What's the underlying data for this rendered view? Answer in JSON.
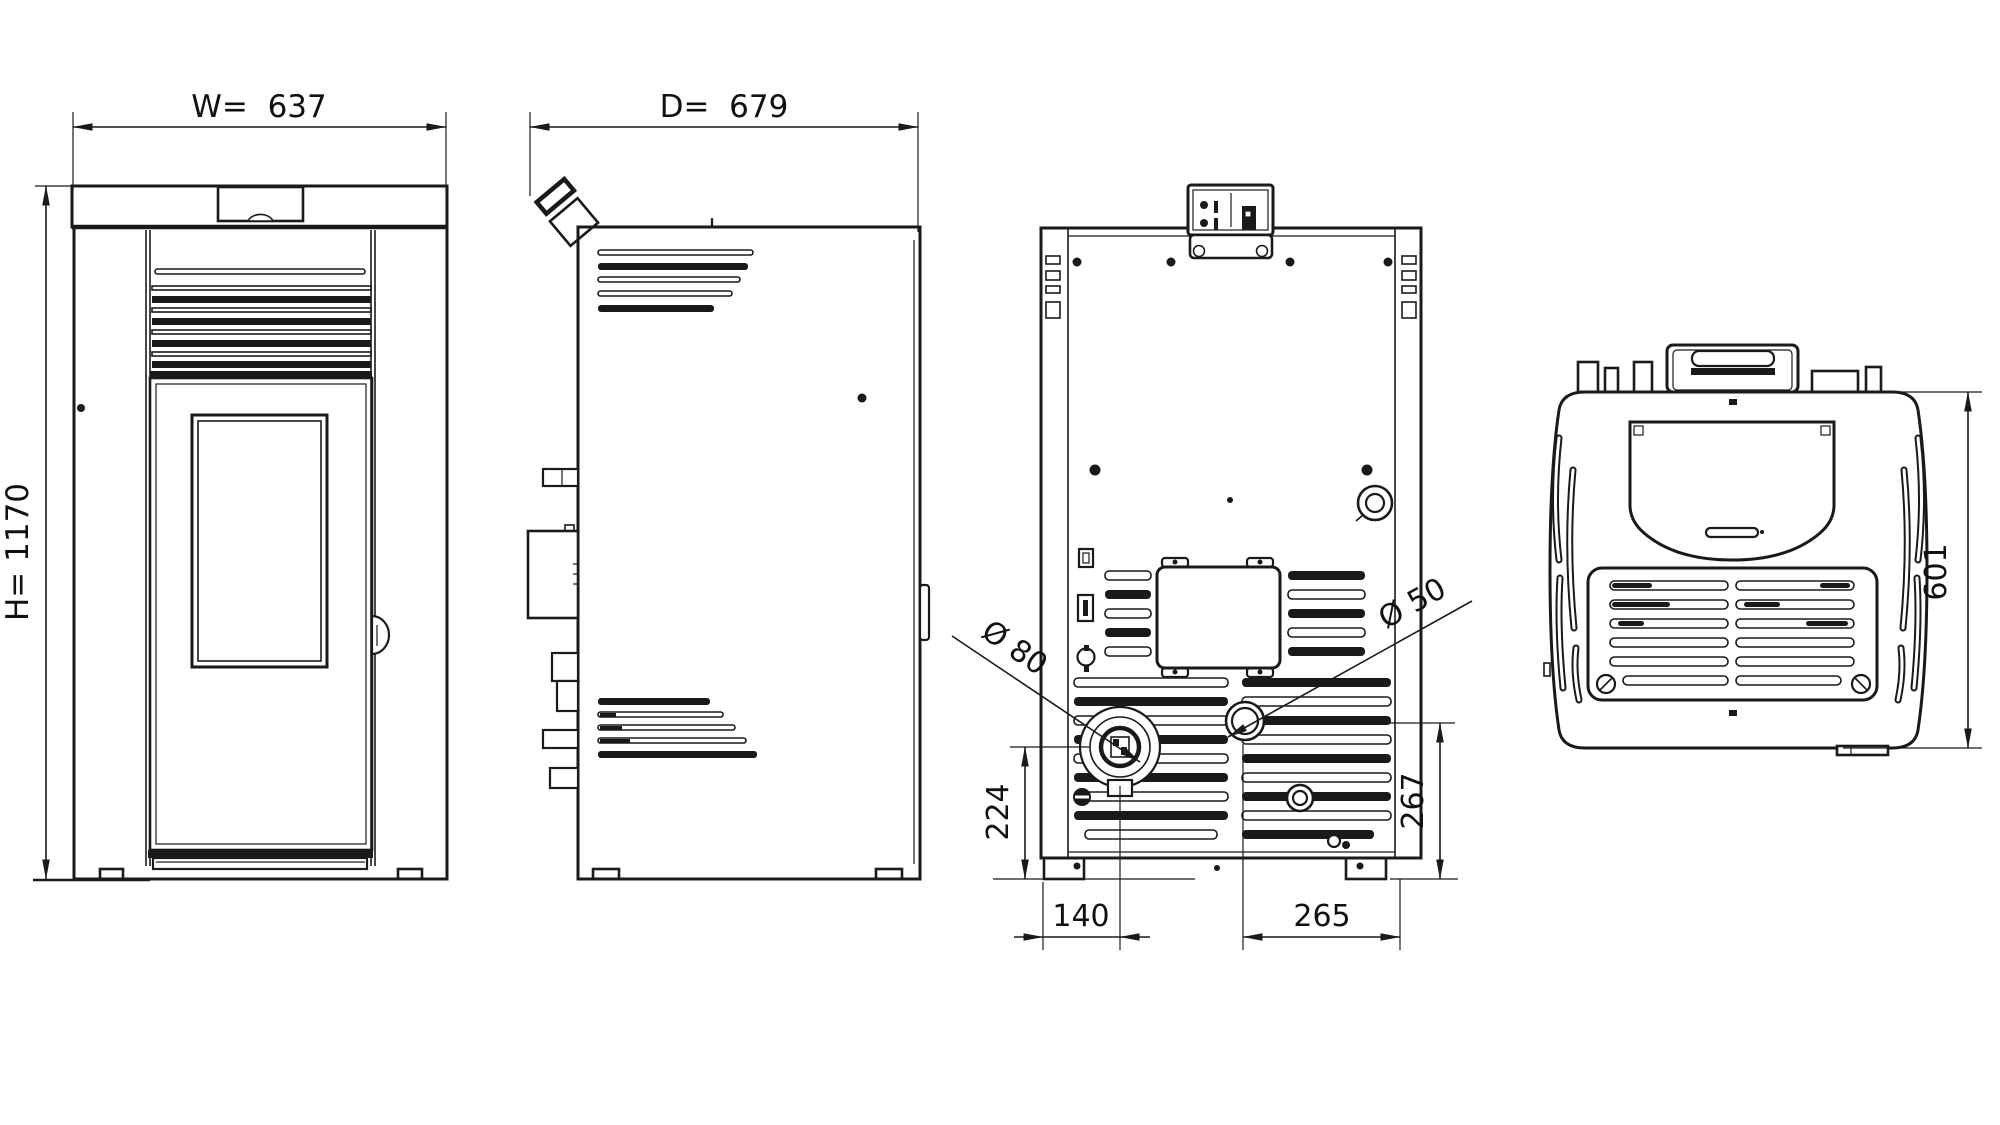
{
  "drawing": {
    "type": "technical-dimensional-drawing",
    "subject": "pellet stove — four orthographic views",
    "background_color": "#ffffff",
    "line_color": "#1a1a1a",
    "views": {
      "front": {
        "name": "front view"
      },
      "side": {
        "name": "side view"
      },
      "rear": {
        "name": "rear view"
      },
      "top": {
        "name": "top view"
      }
    },
    "dimensions": {
      "width": "W=  637",
      "depth": "D=  679",
      "height": "H= 1170",
      "flue_diameter": "Ø 80",
      "intake_diameter": "Ø 50",
      "flue_center_height": "224",
      "intake_center_height": "267",
      "flue_center_offset": "140",
      "intake_center_offset": "265",
      "top_view_depth": "601"
    }
  }
}
